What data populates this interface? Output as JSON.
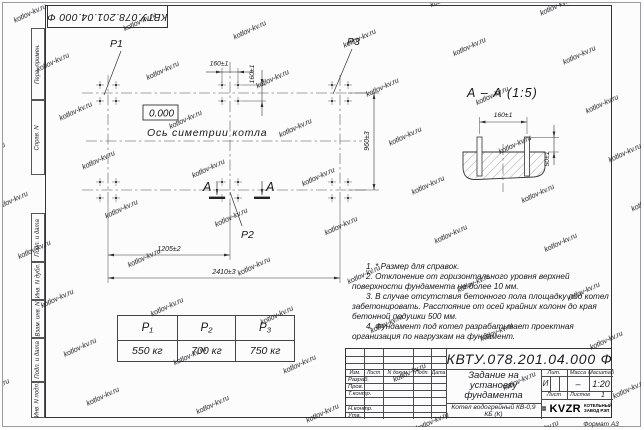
{
  "sheet": {
    "format_label": "Формат А3"
  },
  "watermark": {
    "text": "kotlov-kv.ru"
  },
  "frame": {
    "doc_number_top": "КВТУ.078.201.04.000 Ф",
    "left_stamps": [
      "Перв. примен.",
      "Справ. N",
      "Подп. и дата",
      "Инв. N дубл.",
      "Взам. инв. N",
      "Подп. и дата",
      "Инв. N подл."
    ]
  },
  "plan": {
    "leaders": {
      "p1": "P1",
      "p2": "P2",
      "p3": "P3"
    },
    "elevation": "0.000",
    "axis_label": "Ось симетрии котла",
    "section_letter": "А",
    "dims": {
      "bolt_spacing_x": "160±1",
      "bolt_spacing_y": "160±1",
      "row_spacing": "960±3",
      "half_length": "1205±2",
      "full_length": "2410±3"
    }
  },
  "section": {
    "title": "А – А (1:5)",
    "dims": {
      "bolt_spacing": "160±1",
      "bolt_height": "50±1"
    }
  },
  "loads_table": {
    "headers": [
      "P₁",
      "P₂",
      "P₃"
    ],
    "values": [
      "550 кг",
      "700 кг",
      "750 кг"
    ]
  },
  "notes": [
    "1. * Размер для справок.",
    "2. Отклонение от горизонтального уровня верхней поверхности фундамента не более 10 мм.",
    "3. В случае отсутствия бетонного пола площадку под котел забетонировать. Расстояние от осей крайних колонн до края бетонной подушки 500 мм.",
    "4. Фундамент под котел разрабатывает проектная организация по нагрузкам на фундамент."
  ],
  "title_block": {
    "doc_number": "КВТУ.078.201.04.000 Ф",
    "title": "Задание на установку фундамента",
    "product": "Котел водогрейный КВ-0,9 КБ (К)",
    "cols": [
      "Изм.",
      "Лист",
      "N докум.",
      "Подп.",
      "Дата"
    ],
    "rows": [
      "Разраб.",
      "Пров.",
      "Т.контр.",
      "Н.контр.",
      "Утв."
    ],
    "lit_label": "Лит.",
    "lit_value": "И",
    "mass_label": "Масса",
    "mass_value": "–",
    "scale_label": "Масштаб",
    "scale_value": "1:20",
    "sheet_label": "Лист",
    "sheets_label": "Листов",
    "sheets_value": "1",
    "brand": "KVZR",
    "brand_caption_1": "КОТЕЛЬНЫЙ",
    "brand_caption_2": "ЗАВОД РЭП"
  }
}
